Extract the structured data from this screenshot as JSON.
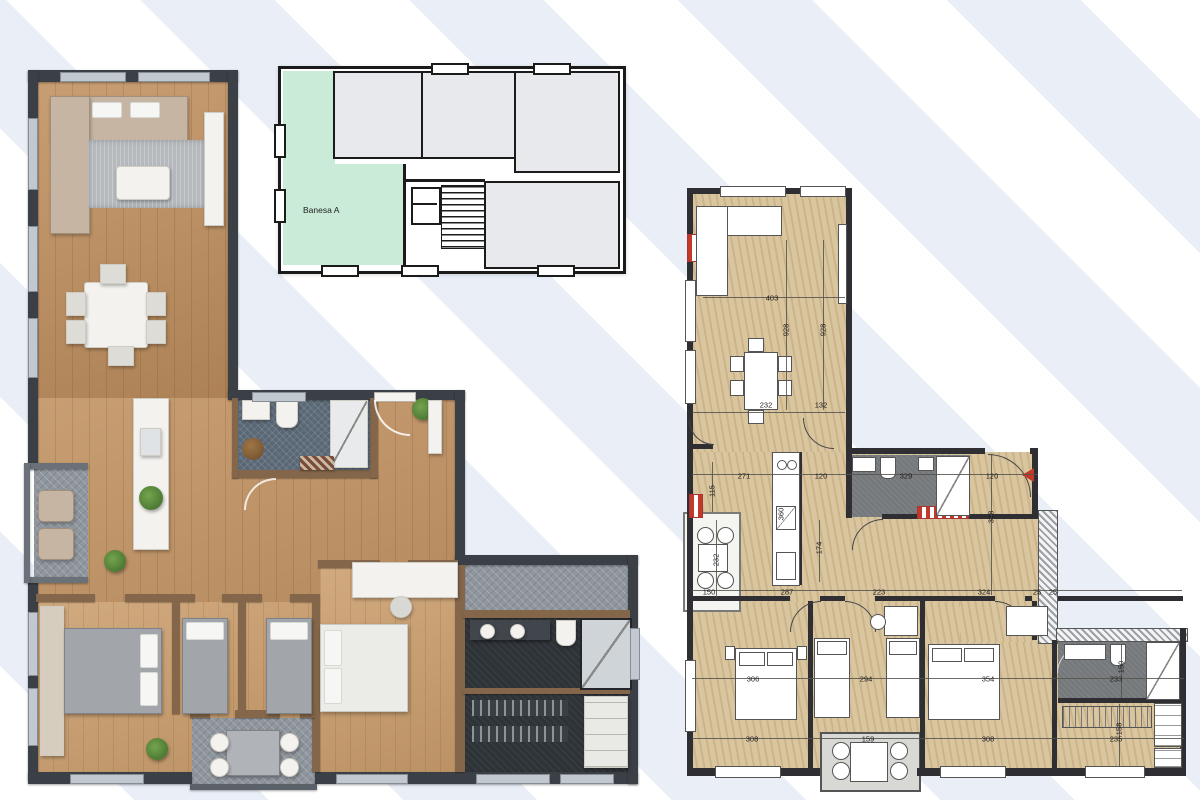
{
  "key_plan": {
    "unit_label": "Banesa A",
    "highlight_color": "#c9ebd8",
    "room_fill": "#e7e9ec",
    "wall_color": "#1b1b1b"
  },
  "colors": {
    "stripe_light": "#ffffff",
    "stripe_blue": "#e9eef7",
    "wood_floor": "#c0905f",
    "dark_wall": "#3b4046",
    "blue_tile": "#5a6876",
    "beige_floor": "#d9c59e",
    "red_marker": "#c0392b"
  },
  "right_plan": {
    "entry_marker": "red-triangle-left",
    "dimensions": [
      {
        "t": "403",
        "x": 772,
        "y": 298,
        "v": false
      },
      {
        "t": "928",
        "x": 786,
        "y": 330,
        "v": true
      },
      {
        "t": "928",
        "x": 823,
        "y": 330,
        "v": true
      },
      {
        "t": "232",
        "x": 766,
        "y": 405,
        "v": false
      },
      {
        "t": "132",
        "x": 821,
        "y": 405,
        "v": false
      },
      {
        "t": "271",
        "x": 744,
        "y": 476,
        "v": false
      },
      {
        "t": "120",
        "x": 821,
        "y": 476,
        "v": false
      },
      {
        "t": "329",
        "x": 906,
        "y": 476,
        "v": false
      },
      {
        "t": "120",
        "x": 992,
        "y": 476,
        "v": false
      },
      {
        "t": "115",
        "x": 712,
        "y": 491,
        "v": true
      },
      {
        "t": "360",
        "x": 781,
        "y": 514,
        "v": true
      },
      {
        "t": "174",
        "x": 819,
        "y": 548,
        "v": true
      },
      {
        "t": "348",
        "x": 991,
        "y": 517,
        "v": true
      },
      {
        "t": "232",
        "x": 716,
        "y": 560,
        "v": true
      },
      {
        "t": "150",
        "x": 709,
        "y": 592,
        "v": false
      },
      {
        "t": "287",
        "x": 787,
        "y": 592,
        "v": false
      },
      {
        "t": "223",
        "x": 879,
        "y": 592,
        "v": false
      },
      {
        "t": "324",
        "x": 984,
        "y": 592,
        "v": false
      },
      {
        "t": "25",
        "x": 1037,
        "y": 592,
        "v": false
      },
      {
        "t": "25",
        "x": 1053,
        "y": 592,
        "v": false
      },
      {
        "t": "306",
        "x": 753,
        "y": 679,
        "v": false
      },
      {
        "t": "294",
        "x": 866,
        "y": 679,
        "v": false
      },
      {
        "t": "354",
        "x": 988,
        "y": 679,
        "v": false
      },
      {
        "t": "308",
        "x": 752,
        "y": 739,
        "v": false
      },
      {
        "t": "159",
        "x": 868,
        "y": 739,
        "v": false
      },
      {
        "t": "308",
        "x": 988,
        "y": 739,
        "v": false
      },
      {
        "t": "150",
        "x": 1121,
        "y": 667,
        "v": true
      },
      {
        "t": "233",
        "x": 1116,
        "y": 679,
        "v": false
      },
      {
        "t": "158",
        "x": 1119,
        "y": 729,
        "v": true
      },
      {
        "t": "235",
        "x": 1116,
        "y": 739,
        "v": false
      }
    ]
  }
}
